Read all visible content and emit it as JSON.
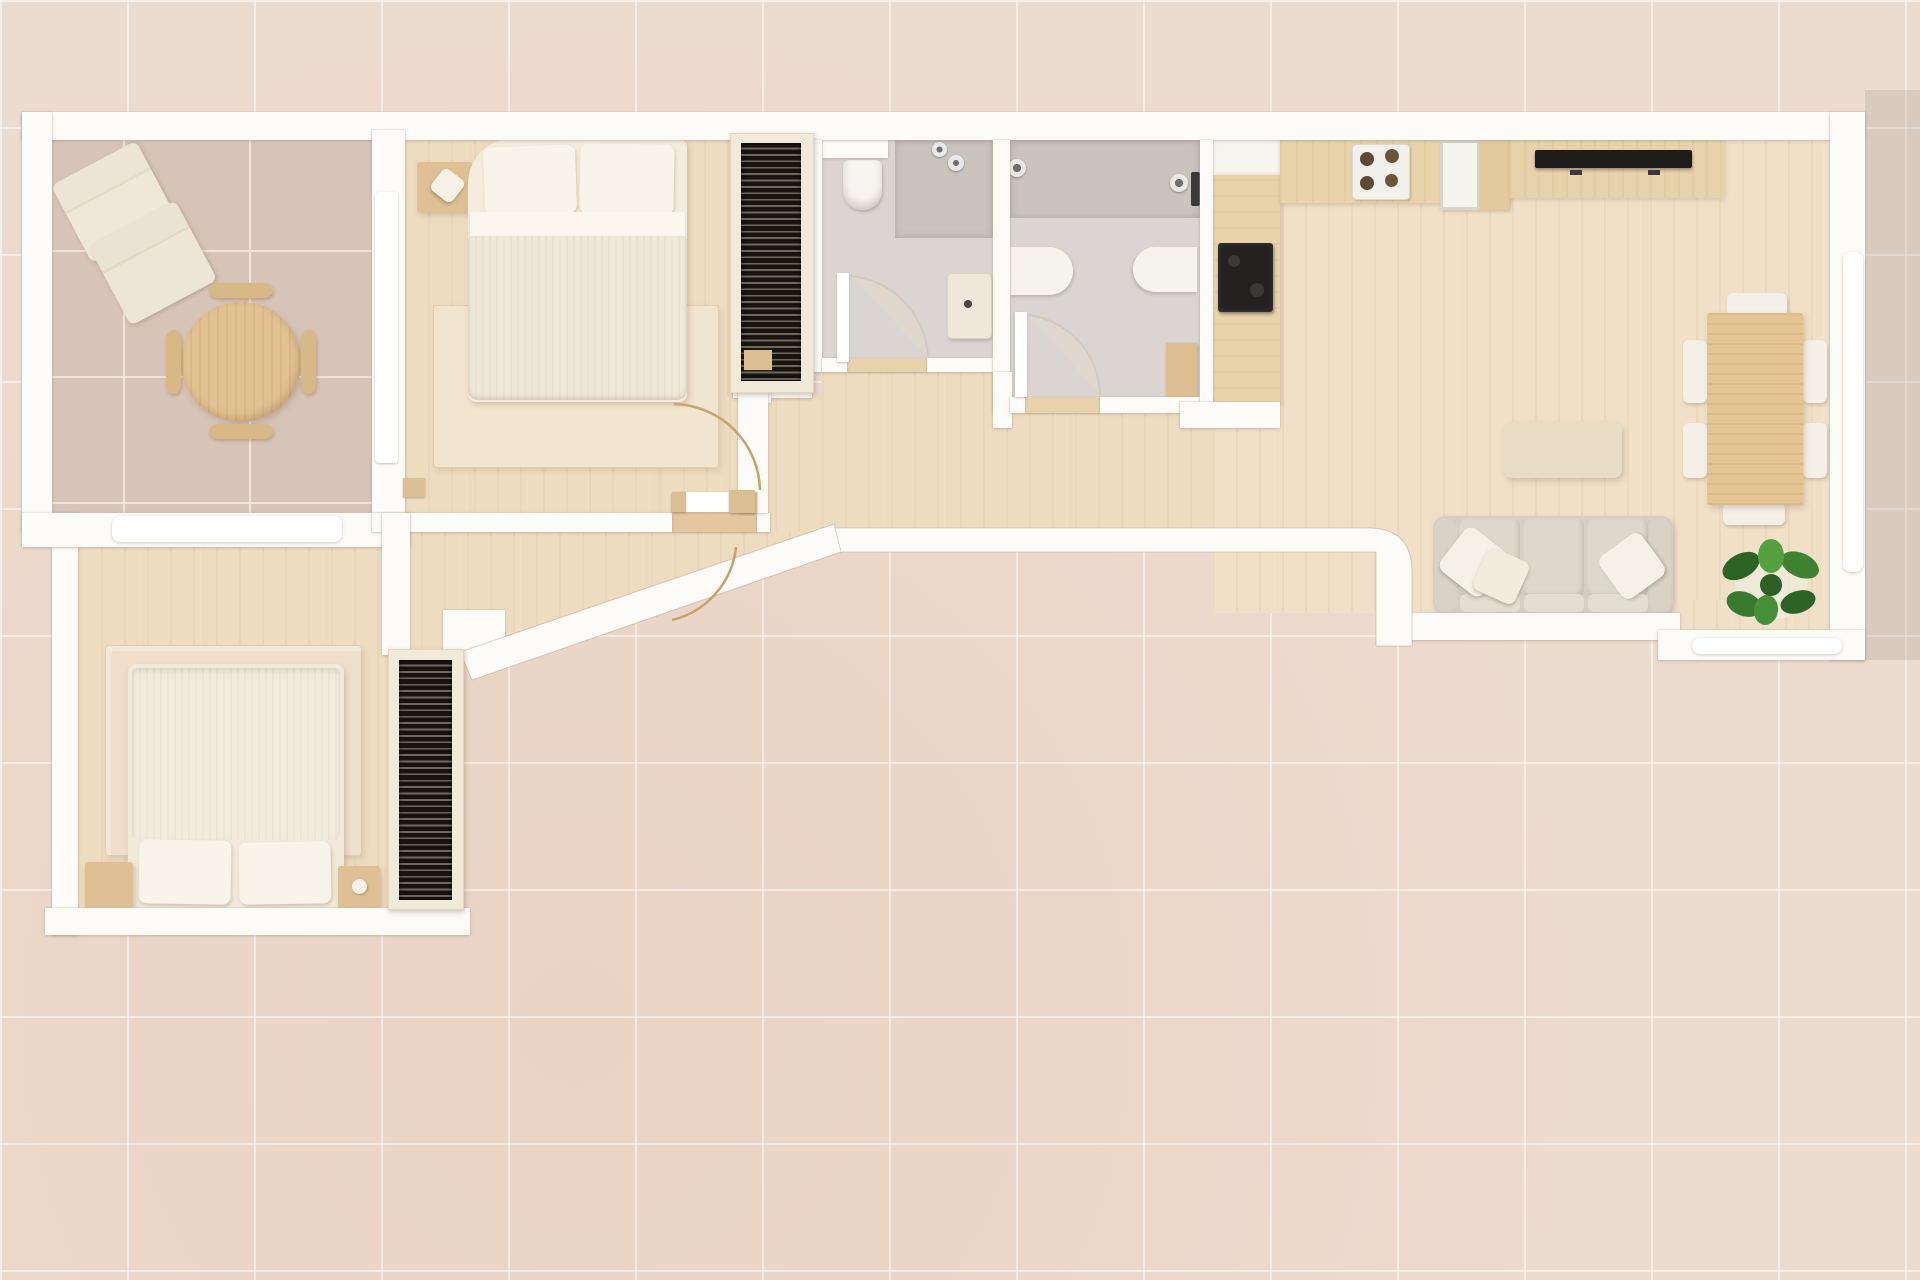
{
  "meta": {
    "type": "apartment-floor-plan-top-view",
    "style": "3d-render",
    "furnished": true,
    "visible_text": ""
  },
  "palette": {
    "exterior_tile": "#ecdbcf",
    "patio_tile": "#eedfd4",
    "wall": "#fcfbf8",
    "wood_floor": "#eedcc1",
    "living_wood": "#f0e0c8",
    "room_tile": "#d7c4b8",
    "bath_tile": "#dad5d2",
    "shower_tile": "#cac4c0",
    "rug": "#f2e5d0",
    "linen": "#f3ecdf",
    "duvet": "#f0e9da",
    "pillow": "#f8f4ea",
    "wardrobe_slats": "#17140f",
    "wardrobe_frame": "#f2ead8",
    "counter_wood": "#e9d3ab",
    "table_wood": "#e3c492",
    "bench_wood": "#d9b888",
    "appliance_black": "#232221",
    "tv_black": "#1e1d1c",
    "sofa": "#dbd4c8",
    "sofa_cushion": "#e1dacd",
    "plant_green_dark": "#2e6326",
    "plant_green": "#3f8232",
    "plant_green_light": "#55a03e",
    "door_arc": "#c9a26b"
  },
  "rooms": [
    {
      "id": "study-dining-room",
      "floor": "ceramic-tile",
      "furniture": [
        "lounge-chair",
        "lounge-chair",
        "round-table",
        "curved-bench-x4"
      ]
    },
    {
      "id": "bedroom-top",
      "floor": "wood",
      "furniture": [
        "double-bed",
        "nightstand",
        "lamp",
        "rug",
        "slatted-wardrobe",
        "swing-door"
      ]
    },
    {
      "id": "bathroom-1",
      "floor": "grey-tile",
      "furniture": [
        "wall-hung-toilet",
        "shower-heads",
        "washbasin-counter",
        "swing-door"
      ]
    },
    {
      "id": "bathroom-2",
      "floor": "grey-tile",
      "furniture": [
        "shower-heads",
        "shower-column",
        "vanity-left",
        "vanity-right",
        "corner-cabinet",
        "swing-door"
      ]
    },
    {
      "id": "kitchen",
      "floor": "wood",
      "furniture": [
        "upper-cabinet",
        "side-counter",
        "black-cooktop",
        "top-counter",
        "four-burner-hob",
        "sink-unit",
        "wood-cabinet"
      ]
    },
    {
      "id": "living-dining-area",
      "floor": "wood",
      "furniture": [
        "tv-console",
        "tv",
        "dining-table",
        "dining-chair-x6",
        "coffee-table",
        "sofa",
        "throw-pillow-x3",
        "potted-plant"
      ]
    },
    {
      "id": "bedroom-bottom",
      "floor": "wood",
      "furniture": [
        "double-bed",
        "nightstand",
        "nightstand",
        "rug",
        "slatted-wardrobe"
      ]
    },
    {
      "id": "hallway-entry",
      "floor": "wood",
      "furniture": [
        "entry-door",
        "diagonal-wall"
      ]
    },
    {
      "id": "patio-exterior",
      "floor": "large-tile",
      "furniture": []
    }
  ],
  "windows": [
    "left-wing-interior-window",
    "right-wall-window",
    "living-bottom-window"
  ],
  "doors": [
    "bedroom-top-door",
    "bathroom-1-door",
    "bathroom-2-door",
    "entry-door",
    "sliding-door-study"
  ]
}
